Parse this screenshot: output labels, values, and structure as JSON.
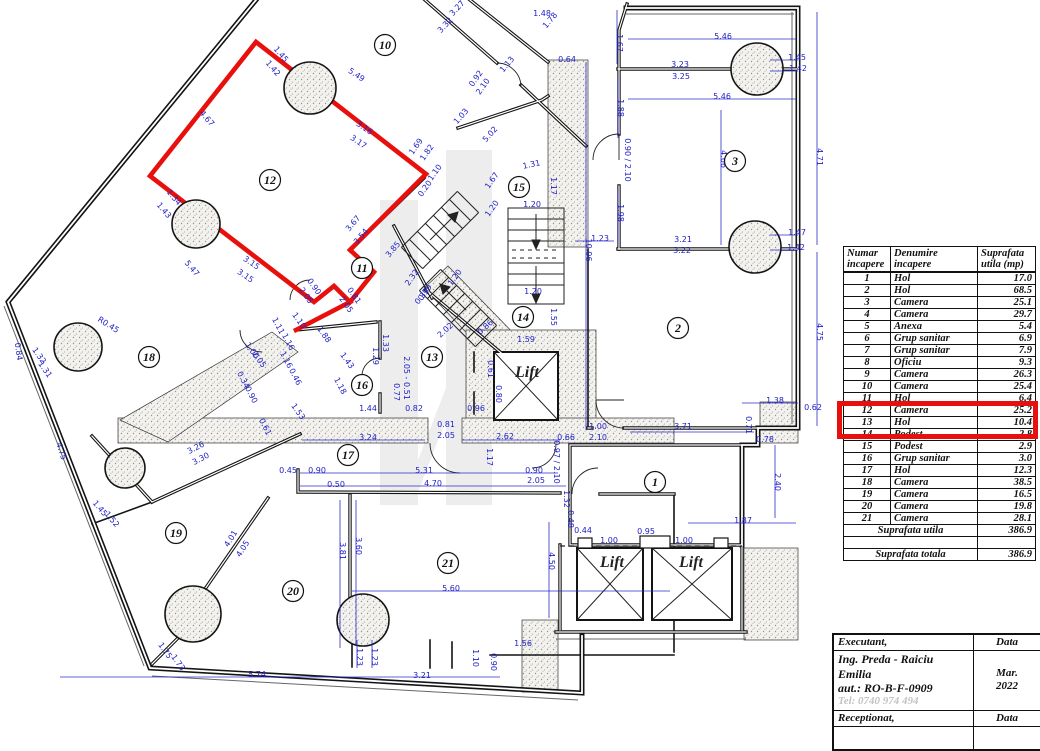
{
  "plan": {
    "colors": {
      "dim_blue": "#2121c8",
      "wall_black": "#141414",
      "highlight_red": "#e8100c"
    },
    "lift_labels": [
      {
        "t": "Lift",
        "x": 527,
        "y": 377
      },
      {
        "t": "Lift",
        "x": 612,
        "y": 567
      },
      {
        "t": "Lift",
        "x": 691,
        "y": 567
      }
    ],
    "room_labels": [
      {
        "n": "1",
        "x": 655,
        "y": 482
      },
      {
        "n": "2",
        "x": 678,
        "y": 328
      },
      {
        "n": "3",
        "x": 735,
        "y": 161
      },
      {
        "n": "10",
        "x": 385,
        "y": 45
      },
      {
        "n": "11",
        "x": 362,
        "y": 268
      },
      {
        "n": "12",
        "x": 270,
        "y": 180
      },
      {
        "n": "13",
        "x": 432,
        "y": 357
      },
      {
        "n": "14",
        "x": 523,
        "y": 317
      },
      {
        "n": "15",
        "x": 519,
        "y": 187
      },
      {
        "n": "16",
        "x": 362,
        "y": 385
      },
      {
        "n": "17",
        "x": 348,
        "y": 455
      },
      {
        "n": "18",
        "x": 149,
        "y": 357
      },
      {
        "n": "19",
        "x": 176,
        "y": 533
      },
      {
        "n": "20",
        "x": 293,
        "y": 591
      },
      {
        "n": "21",
        "x": 448,
        "y": 563
      }
    ],
    "dim_labels": [
      [
        "4.67",
        205,
        120,
        50
      ],
      [
        "1.45",
        279,
        56,
        50
      ],
      [
        "1.42",
        271,
        70,
        50
      ],
      [
        "5.49",
        355,
        77,
        34
      ],
      [
        "3.16",
        363,
        130,
        34
      ],
      [
        "3.17",
        357,
        144,
        34
      ],
      [
        "5.47",
        190,
        270,
        50
      ],
      [
        "1.34",
        172,
        199,
        50
      ],
      [
        "1.43",
        162,
        212,
        50
      ],
      [
        "3.15",
        250,
        265,
        34
      ],
      [
        "3.15",
        244,
        278,
        34
      ],
      [
        "3.67",
        355,
        225,
        -50
      ],
      [
        "3.54",
        363,
        238,
        -50
      ],
      [
        "3.85",
        395,
        251,
        -50
      ],
      [
        "1.11",
        276,
        327,
        62
      ],
      [
        "1.10",
        297,
        322,
        55
      ],
      [
        "1.16",
        286,
        343,
        62
      ],
      [
        "1.16",
        284,
        361,
        62
      ],
      [
        "0.46",
        293,
        378,
        62
      ],
      [
        "1.88",
        322,
        336,
        55
      ],
      [
        "0.90",
        312,
        288,
        55
      ],
      [
        "2.05",
        304,
        297,
        55
      ],
      [
        "0.81",
        352,
        297,
        55
      ],
      [
        "2.05",
        344,
        306,
        55
      ],
      [
        "1.33",
        383,
        343,
        90
      ],
      [
        "1.29",
        373,
        356,
        90
      ],
      [
        "1.43",
        345,
        362,
        55
      ],
      [
        "1.18",
        338,
        387,
        62
      ],
      [
        "1.53",
        296,
        413,
        55
      ],
      [
        "1.44",
        368,
        411,
        0
      ],
      [
        "0.82",
        414,
        411,
        0
      ],
      [
        "0.77",
        394,
        392,
        90
      ],
      [
        "2.05 - 0.51",
        404,
        378,
        90
      ],
      [
        "0.96",
        476,
        411,
        0
      ],
      [
        "0.81",
        446,
        427,
        0
      ],
      [
        "2.05",
        446,
        438,
        0
      ],
      [
        "3.24",
        368,
        440,
        0
      ],
      [
        "2.62",
        505,
        439,
        0
      ],
      [
        "0.66",
        566,
        440,
        0
      ],
      [
        "1.00",
        598,
        429,
        0
      ],
      [
        "2.10",
        598,
        440,
        0
      ],
      [
        "1.17",
        487,
        457,
        90
      ],
      [
        "0.97 / 2.10",
        554,
        462,
        90
      ],
      [
        "5.31",
        424,
        473,
        0
      ],
      [
        "0.90",
        317,
        473,
        0
      ],
      [
        "0.45",
        288,
        473,
        0
      ],
      [
        "4.70",
        433,
        486,
        0
      ],
      [
        "0.90",
        534,
        473,
        0
      ],
      [
        "2.05",
        536,
        483,
        0
      ],
      [
        "0.50",
        336,
        487,
        0
      ],
      [
        "3.81",
        340,
        551,
        90
      ],
      [
        "3.60",
        356,
        546,
        90
      ],
      [
        "5.60",
        451,
        591,
        0
      ],
      [
        "4.50",
        549,
        561,
        90
      ],
      [
        "1.56",
        523,
        646,
        0
      ],
      [
        "1.10",
        473,
        658,
        90
      ],
      [
        "0.90",
        491,
        662,
        90
      ],
      [
        "3.21",
        422,
        678,
        0
      ],
      [
        "1.23",
        357,
        657,
        90
      ],
      [
        "1.23",
        372,
        657,
        90
      ],
      [
        "5.74",
        257,
        677,
        0
      ],
      [
        "1.75",
        163,
        652,
        55
      ],
      [
        "1.73",
        176,
        664,
        55
      ],
      [
        "4.01",
        233,
        540,
        -58
      ],
      [
        "4.05",
        245,
        550,
        -58
      ],
      [
        "3.26",
        197,
        450,
        -28
      ],
      [
        "3.30",
        202,
        461,
        -28
      ],
      [
        "1.45",
        98,
        510,
        50
      ],
      [
        "1.52",
        110,
        521,
        50
      ],
      [
        "4.75",
        59,
        452,
        72
      ],
      [
        "1.32",
        37,
        357,
        55
      ],
      [
        "1.31",
        43,
        371,
        55
      ],
      [
        "0.84",
        16,
        352,
        82
      ],
      [
        "R0.45",
        107,
        327,
        32
      ],
      [
        "1.00",
        250,
        352,
        55
      ],
      [
        "2.05",
        257,
        361,
        55
      ],
      [
        "0.34",
        241,
        381,
        62
      ],
      [
        "0.90",
        249,
        396,
        62
      ],
      [
        "0.61",
        263,
        428,
        62
      ],
      [
        "2.32",
        414,
        279,
        -55
      ],
      [
        "0.39",
        427,
        294,
        -55
      ],
      [
        "1.20",
        457,
        279,
        -55
      ],
      [
        "1.20",
        533,
        294,
        0
      ],
      [
        "1.20",
        494,
        210,
        -55
      ],
      [
        "1.20",
        532,
        207,
        0
      ],
      [
        "1.67",
        494,
        182,
        -55
      ],
      [
        "1.31",
        532,
        167,
        -12
      ],
      [
        "1.17",
        551,
        186,
        90
      ],
      [
        "1.23",
        600,
        241,
        0
      ],
      [
        "10.06",
        586,
        250,
        90
      ],
      [
        "1.55",
        551,
        317,
        90
      ],
      [
        "1.59",
        526,
        342,
        0
      ],
      [
        "0.61",
        488,
        369,
        90
      ],
      [
        "0.80",
        496,
        394,
        90
      ],
      [
        "2.02",
        447,
        332,
        -42
      ],
      [
        "0.86",
        487,
        329,
        -42
      ],
      [
        "0.39",
        424,
        298,
        -50
      ],
      [
        "1.69",
        418,
        148,
        -55
      ],
      [
        "1.82",
        429,
        154,
        -55
      ],
      [
        "1.10",
        437,
        174,
        -55
      ],
      [
        "0.20",
        427,
        190,
        -55
      ],
      [
        "5.02",
        492,
        136,
        -48
      ],
      [
        "1.03",
        463,
        118,
        -48
      ],
      [
        "0.92",
        478,
        80,
        -55
      ],
      [
        "2.10",
        485,
        88,
        -55
      ],
      [
        "0.64",
        567,
        62,
        0
      ],
      [
        "1.67",
        617,
        43,
        90
      ],
      [
        "5.46",
        723,
        39,
        0
      ],
      [
        "3.23",
        680,
        67,
        0
      ],
      [
        "3.25",
        681,
        79,
        0
      ],
      [
        "1.45",
        797,
        60,
        0
      ],
      [
        "1.42",
        798,
        71,
        0
      ],
      [
        "5.46",
        722,
        99,
        0
      ],
      [
        "1.88",
        618,
        108,
        90
      ],
      [
        "4.66",
        721,
        159,
        90
      ],
      [
        "4.71",
        817,
        157,
        90
      ],
      [
        "0.90 / 2.10",
        625,
        160,
        90
      ],
      [
        "1.98",
        618,
        213,
        90
      ],
      [
        "3.21",
        683,
        242,
        0
      ],
      [
        "3.22",
        682,
        253,
        0
      ],
      [
        "1.47",
        797,
        235,
        0
      ],
      [
        "1.42",
        796,
        250,
        0
      ],
      [
        "4.75",
        817,
        332,
        90
      ],
      [
        "1.38",
        775,
        403,
        0
      ],
      [
        "0.62",
        813,
        410,
        0
      ],
      [
        "0.71",
        746,
        425,
        90
      ],
      [
        "3.71",
        683,
        429,
        0
      ],
      [
        "0.78",
        765,
        442,
        0
      ],
      [
        "2.40",
        775,
        482,
        90
      ],
      [
        "1.87",
        743,
        523,
        0
      ],
      [
        "0.48",
        568,
        519,
        90
      ],
      [
        "0.44",
        583,
        533,
        0
      ],
      [
        "1.00",
        609,
        543,
        0
      ],
      [
        "0.95",
        646,
        534,
        0
      ],
      [
        "1.00",
        684,
        543,
        0
      ],
      [
        "1.32",
        564,
        499,
        90
      ],
      [
        "3.32",
        447,
        27,
        -47
      ],
      [
        "3.27",
        459,
        10,
        -47
      ],
      [
        "1.48",
        542,
        16,
        0
      ],
      [
        "1.78",
        552,
        22,
        -50
      ],
      [
        "1.13",
        509,
        66,
        -50
      ]
    ]
  },
  "table": {
    "headers": [
      {
        "l1": "Numar",
        "l2": "incapere"
      },
      {
        "l1": "Denumire",
        "l2": "incapere"
      },
      {
        "l1": "Suprafata",
        "l2": "utila (mp)"
      }
    ],
    "rows": [
      {
        "nr": "1",
        "den": "Hol",
        "sup": "17.0",
        "hl": false
      },
      {
        "nr": "2",
        "den": "Hol",
        "sup": "68.5",
        "hl": false
      },
      {
        "nr": "3",
        "den": "Camera",
        "sup": "25.1",
        "hl": false
      },
      {
        "nr": "4",
        "den": "Camera",
        "sup": "29.7",
        "hl": false
      },
      {
        "nr": "5",
        "den": "Anexa",
        "sup": "5.4",
        "hl": false
      },
      {
        "nr": "6",
        "den": "Grup sanitar",
        "sup": "6.9",
        "hl": false
      },
      {
        "nr": "7",
        "den": "Grup sanitar",
        "sup": "7.9",
        "hl": false
      },
      {
        "nr": "8",
        "den": "Oficiu",
        "sup": "9.3",
        "hl": false
      },
      {
        "nr": "9",
        "den": "Camera",
        "sup": "26.3",
        "hl": false
      },
      {
        "nr": "10",
        "den": "Camera",
        "sup": "25.4",
        "hl": false
      },
      {
        "nr": "11",
        "den": "Hol",
        "sup": "6.4",
        "hl": true
      },
      {
        "nr": "12",
        "den": "Camera",
        "sup": "25.2",
        "hl": true
      },
      {
        "nr": "13",
        "den": "Hol",
        "sup": "10.4",
        "hl": false
      },
      {
        "nr": "14",
        "den": "Podest",
        "sup": "2.8",
        "hl": false
      },
      {
        "nr": "15",
        "den": "Podest",
        "sup": "2.9",
        "hl": false
      },
      {
        "nr": "16",
        "den": "Grup sanitar",
        "sup": "3.0",
        "hl": false
      },
      {
        "nr": "17",
        "den": "Hol",
        "sup": "12.3",
        "hl": false
      },
      {
        "nr": "18",
        "den": "Camera",
        "sup": "38.5",
        "hl": false
      },
      {
        "nr": "19",
        "den": "Camera",
        "sup": "16.5",
        "hl": false
      },
      {
        "nr": "20",
        "den": "Camera",
        "sup": "19.8",
        "hl": false
      },
      {
        "nr": "21",
        "den": "Camera",
        "sup": "28.1",
        "hl": false
      }
    ],
    "totals": [
      {
        "label": "Suprafata utila",
        "value": "386.9"
      },
      {
        "label": "",
        "value": ""
      },
      {
        "label": "Suprafata totala",
        "value": "386.9"
      }
    ]
  },
  "title_block": {
    "executant_label": "Executant,",
    "data_label": "Data",
    "executant_name": "Ing. Preda - Raiciu Emilia",
    "executant_aut": "aut.: RO-B-F-0909",
    "executant_tel": "Tel: 0740 974 494",
    "date_line1": "Mar.",
    "date_line2": "2022",
    "receptionat_label": "Receptionat,",
    "data_label2": "Data"
  }
}
